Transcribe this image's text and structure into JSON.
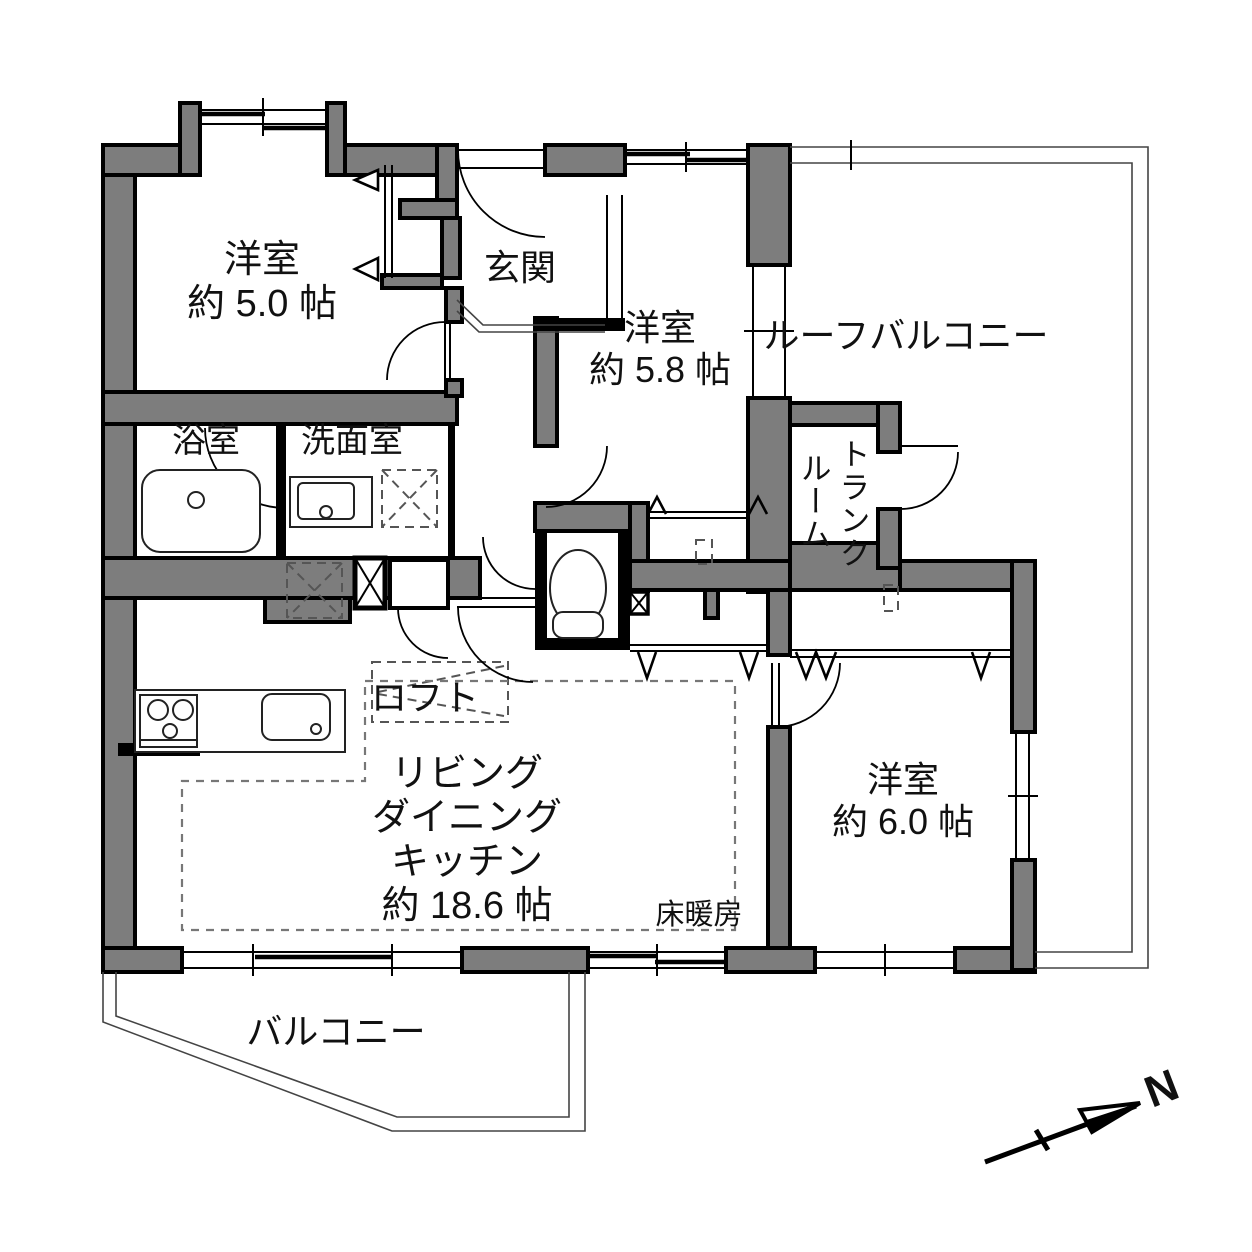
{
  "plan": {
    "title": "apartment-floorplan",
    "colors": {
      "wall": "#7d7d7d",
      "line": "#000000",
      "background": "#ffffff"
    },
    "rooms": {
      "bedroom_nw": {
        "name": "洋室",
        "size": "約 5.0 帖"
      },
      "entrance": {
        "name": "玄関"
      },
      "bedroom_n": {
        "name": "洋室",
        "size": "約 5.8 帖"
      },
      "roof_balcony": {
        "name": "ルーフバルコニー"
      },
      "trunk_room": {
        "name_col1": "トランク",
        "name_col2": "ルーム"
      },
      "bathroom": {
        "name": "浴室"
      },
      "washroom": {
        "name": "洗面室"
      },
      "loft": {
        "name": "ロフト"
      },
      "ldk": {
        "line1": "リビング",
        "line2": "ダイニング",
        "line3": "キッチン",
        "size": "約 18.6 帖"
      },
      "floor_heating": {
        "name": "床暖房"
      },
      "bedroom_e": {
        "name": "洋室",
        "size": "約 6.0 帖"
      },
      "balcony": {
        "name": "バルコニー"
      }
    },
    "compass": {
      "label": "N"
    }
  }
}
